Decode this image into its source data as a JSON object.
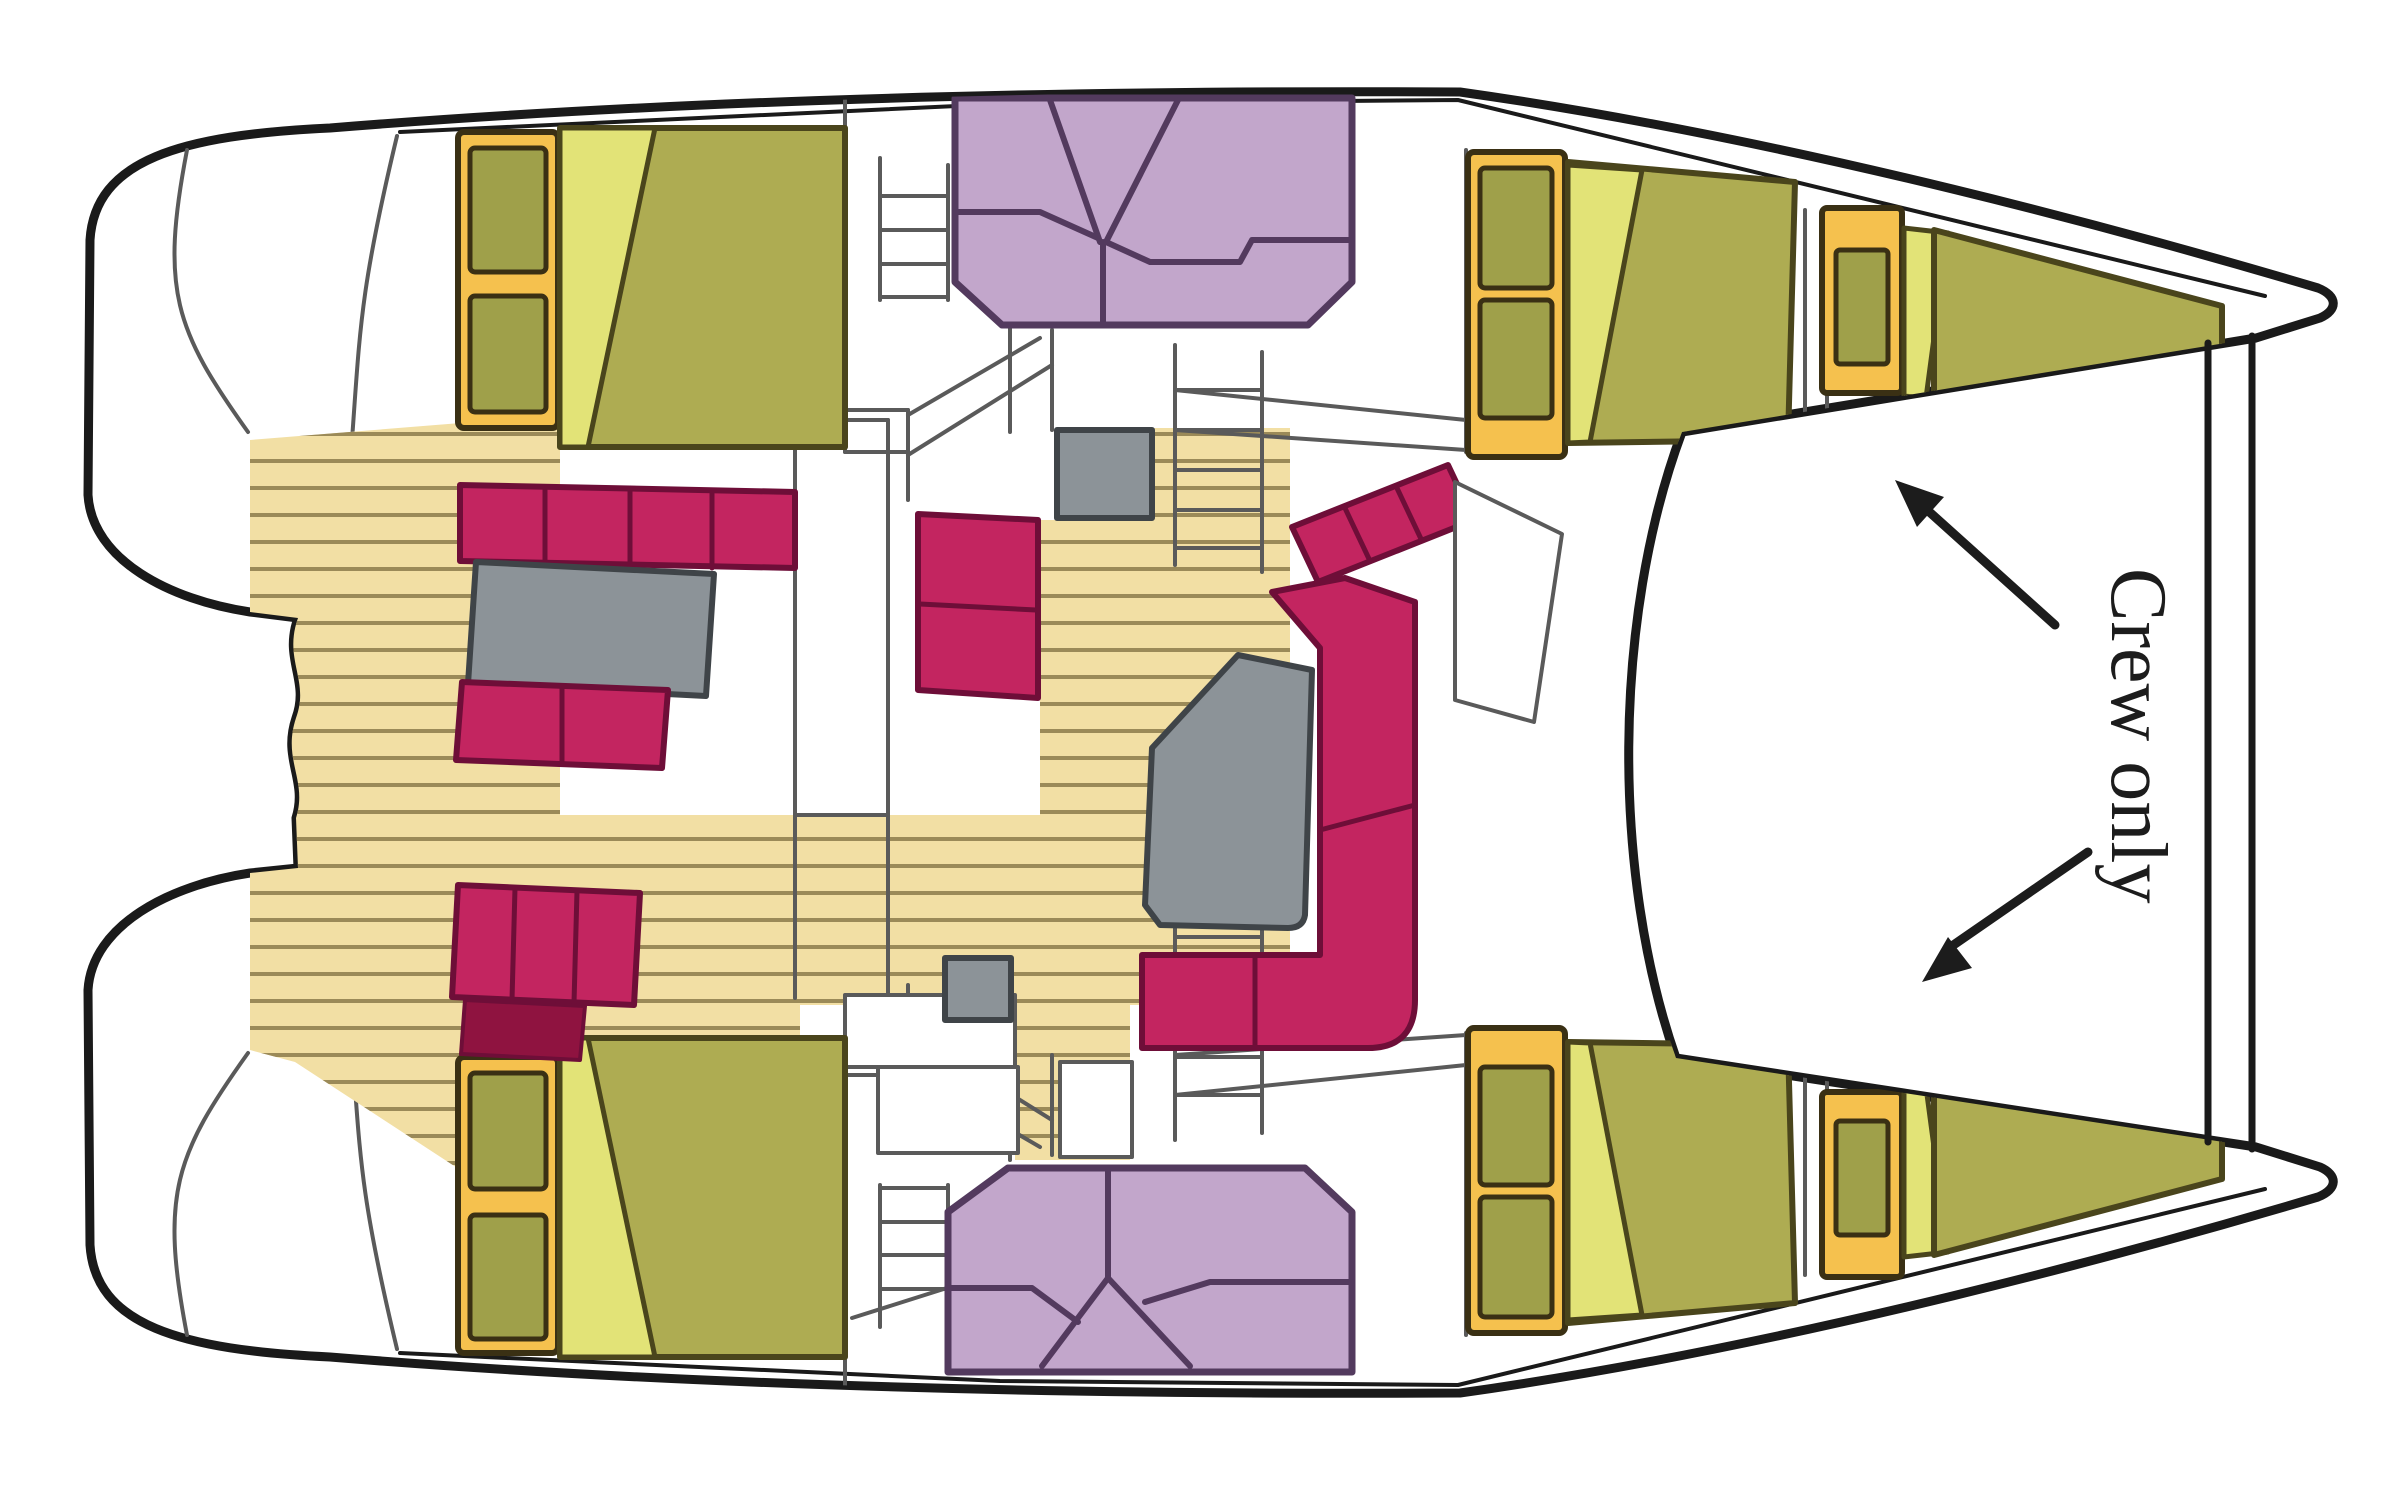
{
  "figure": {
    "type": "floor-plan",
    "subject": "catamaran yacht deck layout, top view, bows to the right",
    "areas": [
      "port-aft-cabin",
      "starboard-aft-cabin",
      "port-forward-cabin",
      "starboard-forward-cabin",
      "port-bow-crew-berth",
      "starboard-bow-crew-berth",
      "cockpit-teak-deck",
      "saloon-sofa-and-table",
      "dinette-bench-and-table",
      "aft-lounge-seat",
      "forward-lounge-seat",
      "companionway-stairs"
    ]
  },
  "annotations": {
    "crew_only": {
      "text": "Crew only",
      "orientation": "vertical",
      "arrows": [
        "toward-port-bow-berth",
        "toward-starboard-bow-berth"
      ]
    }
  },
  "palette": {
    "hull": "#1a1a1a",
    "wall": "#5a5a5a",
    "teak": "#F2DFA4",
    "teak_stripe": "#9b8a58",
    "bed": "#AEAC52",
    "bed_dark": "#4a451c",
    "blanket": "#E2E377",
    "wardrobe": "#F5C14E",
    "wardrobe_dark": "#3a3014",
    "cushion": "#9FA04A",
    "sofa": "#C32560",
    "sofa_dark": "#6e0e38",
    "sofa_shadow": "#8f1340",
    "purple": "#C2A6CB",
    "purple_line": "#533A5E",
    "gray": "#8C9398",
    "gray_dark": "#3f4448",
    "white": "#ffffff",
    "text": "#1c1c1c"
  }
}
